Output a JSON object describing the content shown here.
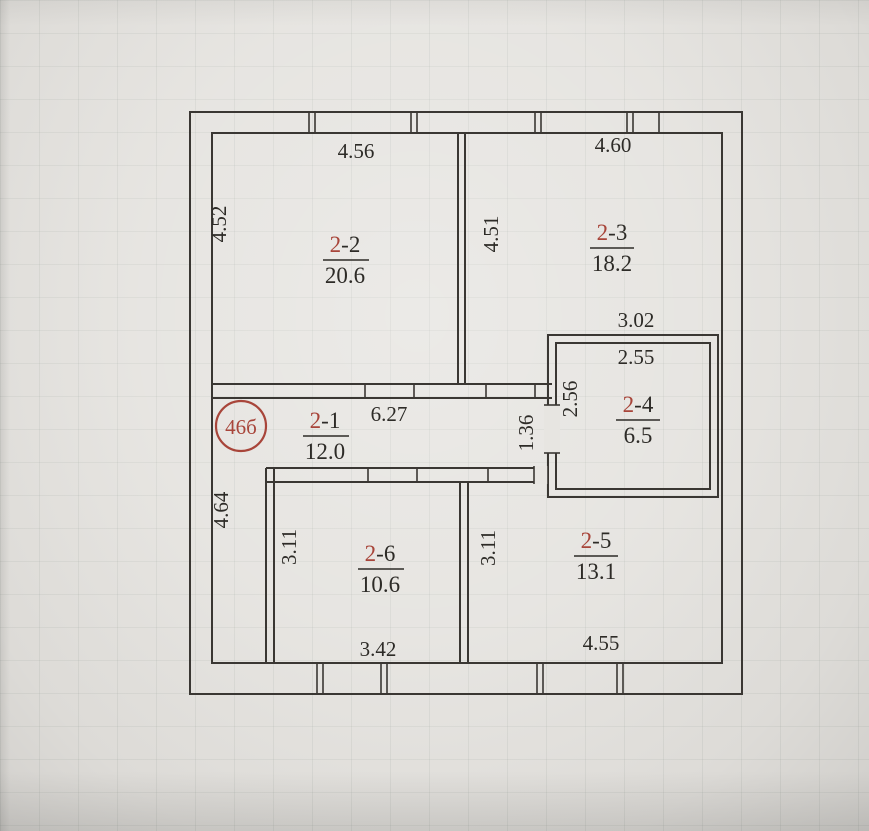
{
  "document": {
    "type": "apartment floor plan (scan)"
  },
  "stamp": {
    "label": "46б"
  },
  "colors": {
    "accent_red": "#a8453a",
    "wall_line": "#3a3733",
    "text": "#2d2b27",
    "paper": "#e4e2de"
  },
  "rooms": {
    "r21": {
      "prefix": "2",
      "suffix": "-1",
      "area": "12.0"
    },
    "r22": {
      "prefix": "2",
      "suffix": "-2",
      "area": "20.6"
    },
    "r23": {
      "prefix": "2",
      "suffix": "-3",
      "area": "18.2"
    },
    "r24": {
      "prefix": "2",
      "suffix": "-4",
      "area": "6.5"
    },
    "r25": {
      "prefix": "2",
      "suffix": "-5",
      "area": "13.1"
    },
    "r26": {
      "prefix": "2",
      "suffix": "-6",
      "area": "10.6"
    }
  },
  "dims": {
    "room22_width": "4.56",
    "room22_height": "4.52",
    "room23_width": "4.60",
    "room23_height": "4.51",
    "room24_outer_width": "3.02",
    "room24_inner_width": "2.55",
    "room24_inner_height": "2.56",
    "hall_length": "6.27",
    "hall_opening": "1.36",
    "left_lower_height": "4.64",
    "room26_height": "3.11",
    "room26_width": "3.42",
    "room25_height": "3.11",
    "room25_width": "4.55"
  }
}
